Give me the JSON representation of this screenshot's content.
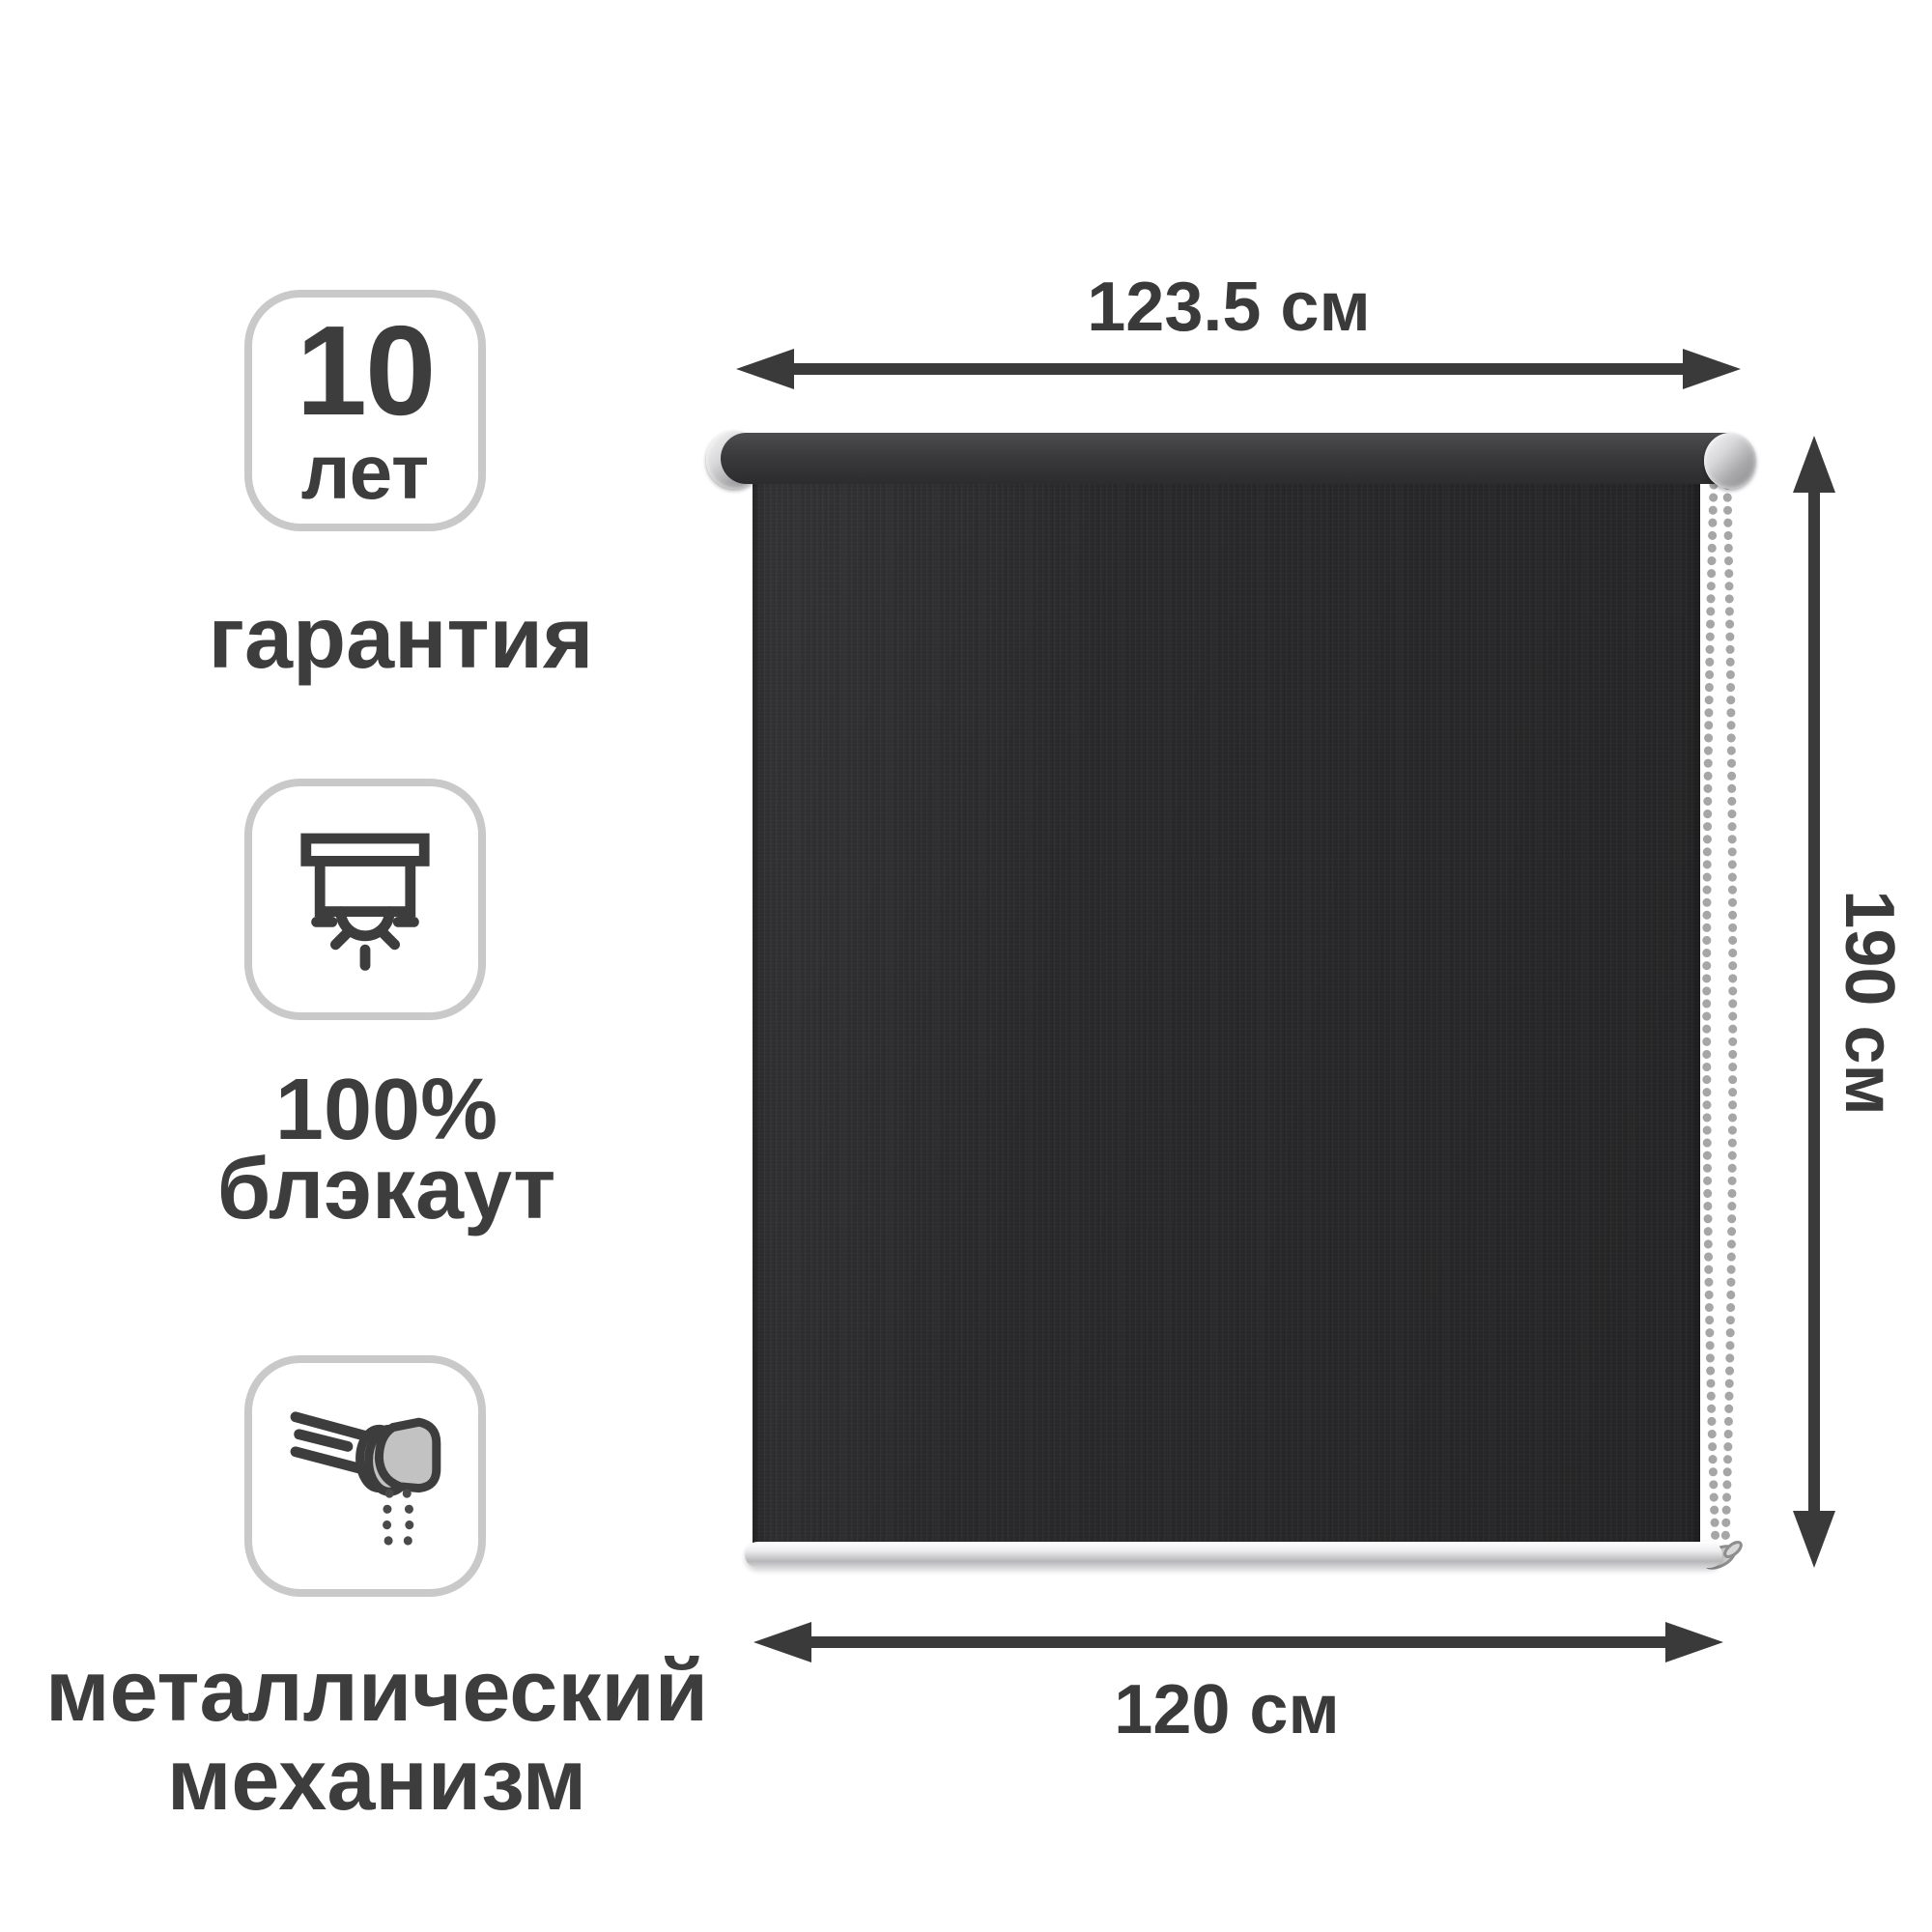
{
  "badges": {
    "warranty": {
      "value": "10",
      "unit": "лет",
      "label": "гарантия"
    },
    "blackout": {
      "line1": "100%",
      "line2": "блэкаут"
    },
    "mechanism": {
      "line1": "металлический",
      "line2": "механизм"
    }
  },
  "dimensions": {
    "top_width": "123.5 см",
    "height": "190 см",
    "bottom_width": "120 см"
  },
  "product": {
    "type": "roller-blind"
  },
  "colors": {
    "annotation": "#3a3a3a",
    "text": "#3d3d3d",
    "badge_border": "#c9c9c9",
    "fabric": "#2a2a2c",
    "tube": "#3a3a3c",
    "metal_light": "#f2f2f4",
    "metal_dark": "#97979a",
    "icon_gray_fill": "#c2c2c2"
  }
}
